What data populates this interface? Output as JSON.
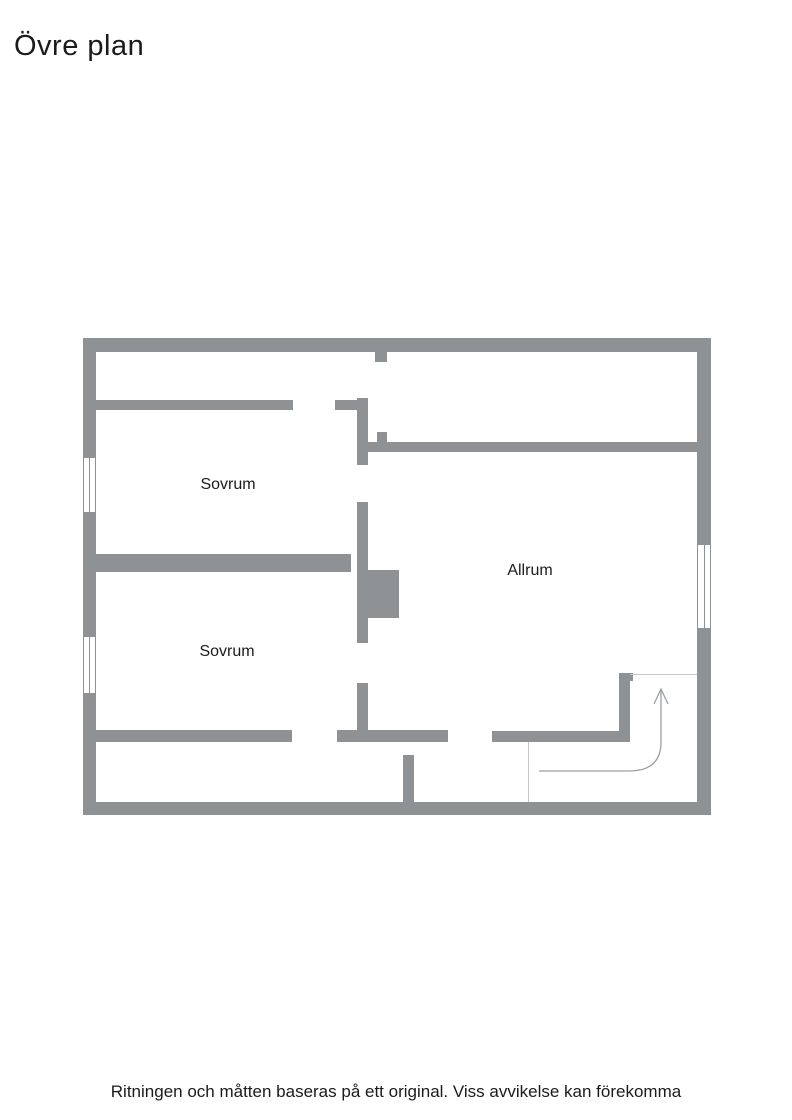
{
  "page": {
    "title": "Övre plan",
    "disclaimer": "Ritningen och måtten baseras på ett original. Viss avvikelse kan förekomma"
  },
  "floorplan": {
    "floor_name": "Övre plan",
    "rooms": [
      {
        "label": "Sovrum"
      },
      {
        "label": "Sovrum"
      },
      {
        "label": "Allrum"
      }
    ],
    "features": {
      "windows": 3,
      "stairs_direction": "up"
    },
    "colors": {
      "wall": "#8e9294",
      "stair_line": "#c4c8ca",
      "arrow": "#9aa0a3",
      "text": "#1b1b1b",
      "bg": "#ffffff"
    }
  }
}
